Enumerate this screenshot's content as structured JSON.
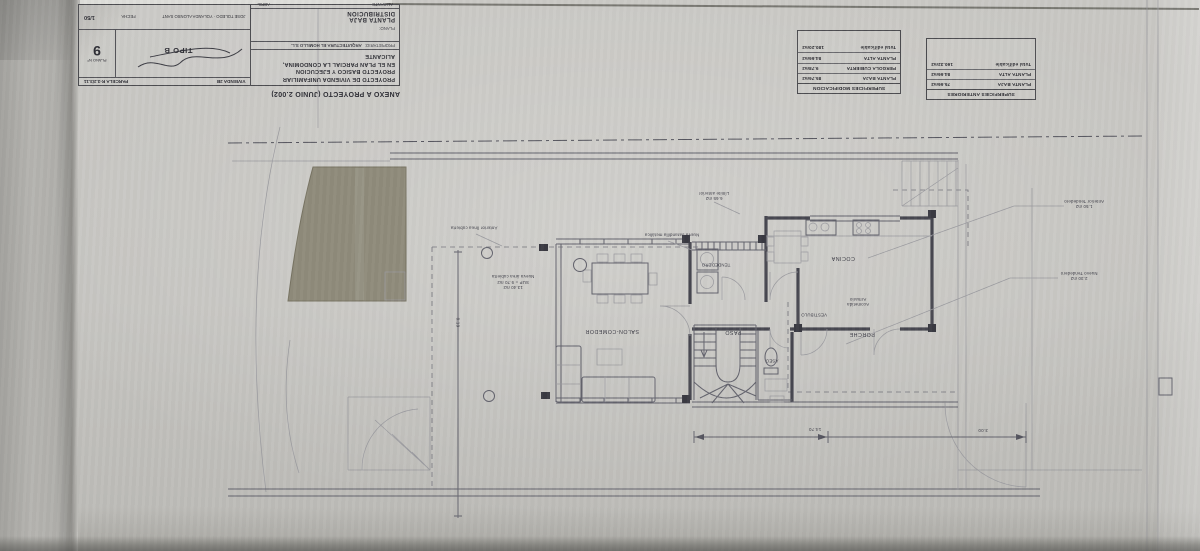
{
  "titleblock": {
    "annex": "ANEXO A PROYECTO (JUNIO 2.002)",
    "line1": "PROYECTO DE VIVIENDA UNIFAMILIAR",
    "line2": "PROYECTO BASICO Y EJECUCION",
    "line3": "EN EL PLAN PARCIAL LA CONDOMINA, ALICANTE",
    "owner_label": "PROPIETARIO:",
    "owner": "ARQUITECTURA EL HOMILLO S.L.",
    "plano_label": "PLANO:",
    "plano_name1": "PLANTA BAJA",
    "plano_name2": "DISTRIBUCION",
    "city": "ALICANTE",
    "month": "ABRIL",
    "fecha_label": "FECHA",
    "architects": "JOSE TOLEDO · YOLANDA ALONSO SANT",
    "escala": "1/50",
    "tipo": "TIPO B",
    "parcela": "PARCELA R-3.2/3.11",
    "vivienda": "VIVIENDA 2B",
    "plano_num_label": "PLANO Nº",
    "plano_num": "9"
  },
  "tables": {
    "modificacion": {
      "title": "SUPERFICIES MODIFICACION",
      "rows": [
        {
          "label": "PLANTA BAJA",
          "value": "85.76m2"
        },
        {
          "label": "PERGOLA CUBIERTA",
          "value": "9.78m2"
        },
        {
          "label": "PLANTA ALTA",
          "value": "84.66m2"
        },
        {
          "label": "Total edificable",
          "value": "180.20m2"
        }
      ]
    },
    "anteriores": {
      "title": "SUPERFICIES ANTERIORES",
      "rows": [
        {
          "label": "PLANTA BAJA",
          "value": "75.66m2"
        },
        {
          "label": "PLANTA ALTA",
          "value": "84.66m2"
        },
        {
          "label": "Total edificable",
          "value": "160.32m2"
        }
      ]
    }
  },
  "plan": {
    "rooms": {
      "salon": "SALON-COMEDOR",
      "paso": "PASO",
      "aseo": "ASEO",
      "vestibulo": "VESTIBULO",
      "cocina": "COCINA",
      "tendedero": "TENDEDERO",
      "porche": "PORCHE"
    },
    "annotations": {
      "armario1": "Armario",
      "armario2": "Acometida",
      "nueva_area1": "Nueva área cubierta",
      "nueva_area2": "SUP = 9.70 m2",
      "nueva_area3": "13.40 m2",
      "anterior_linea": "Anterior línea cubierta",
      "limite1": "Límite anterior",
      "limite2": "6.65 m2",
      "barandilla": "Nueva barandilla metálica",
      "callout_top1": "Anterior Tendedero",
      "callout_top2": "1.50 m2",
      "callout_bot1": "Nuevo Tendedero",
      "callout_bot2": "2.30 m2"
    },
    "dims": {
      "d1": "14.70",
      "d2": "3.00",
      "v1": "8.19"
    }
  },
  "colors": {
    "paper": "#c6c5c1",
    "line": "#63636d",
    "wall": "#474750",
    "pool_shade": "#8f8b7b"
  }
}
